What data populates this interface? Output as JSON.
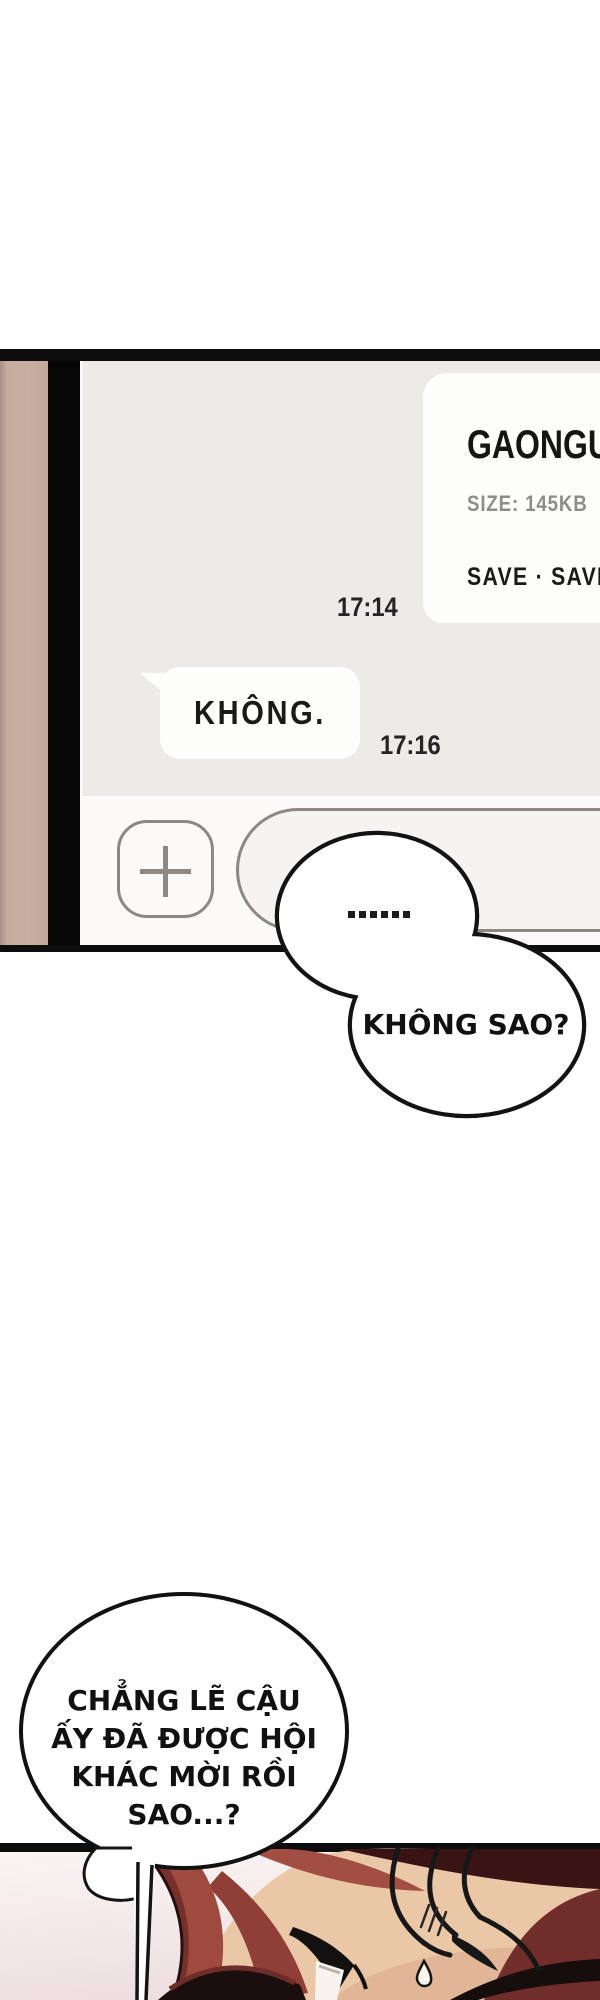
{
  "phone_panel": {
    "file_message": {
      "title": "GAONGUIL",
      "size_label": "SIZE: 145KB",
      "actions_label": "SAVE · SAVE",
      "timestamp": "17:14"
    },
    "reply_message": {
      "text": "KHÔNG.",
      "timestamp": "17:16"
    },
    "input_bar": {
      "add_icon": "plus-icon",
      "input_value": "",
      "input_placeholder": ""
    }
  },
  "speech_bubbles": {
    "ellipsis": {
      "text": "......"
    },
    "khong_sao": {
      "text": "KHÔNG SAO?"
    },
    "bottom": {
      "lines": [
        "CHẲNG LẼ CẬU",
        "ẤY ĐÃ ĐƯỢC HỘI",
        "KHÁC MỜI RỒI",
        "SAO...?"
      ]
    }
  },
  "colors": {
    "panel_border": "#0d0d0d",
    "tan_strip": "#c6ab9e",
    "chat_background": "#edebe7",
    "bubble_white": "#fdfdfc",
    "muted_text": "#8f8d8a",
    "dark_text": "#1b1a19",
    "input_bar": "#fbfaf8",
    "field_border": "#8d8883",
    "hair_red": "#9f4a3f",
    "hair_dark_maroon": "#3a1315",
    "skin": "#eac7a6",
    "art_background": "#f4e9e8"
  }
}
